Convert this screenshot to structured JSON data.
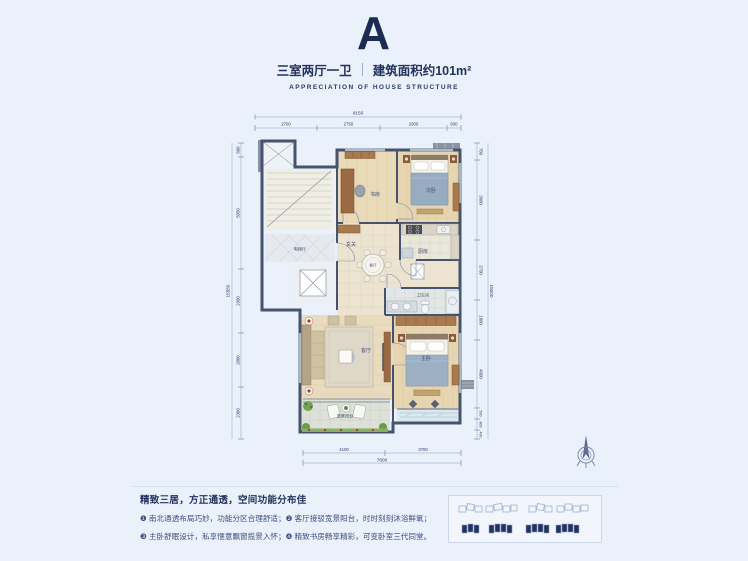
{
  "header": {
    "unit_letter": "A",
    "spec": "三室两厅一卫",
    "area": "建筑面积约101m²",
    "subtitle": "APPRECIATION OF HOUSE STRUCTURE"
  },
  "plan": {
    "rooms": {
      "elevator_hall": "电梯厅",
      "study": "书房",
      "bedroom2": "次卧",
      "foyer": "玄关",
      "dining": "餐厅",
      "kitchen": "厨房",
      "bathroom": "卫生间",
      "living": "客厅",
      "master": "主卧",
      "balcony": "宽景阳台"
    },
    "dims": {
      "top_total": "9150",
      "top": [
        "2700",
        "2750",
        "2900",
        "600"
      ],
      "bottom_total": "7800",
      "bottom": [
        "4100",
        "3700"
      ],
      "left_total": "15550",
      "left": [
        "600",
        "5050",
        "2900",
        "2000",
        "2300"
      ],
      "right_total": "15000",
      "right": [
        "780",
        "3600",
        "2700",
        "1800",
        "4000",
        "500",
        "800",
        "400"
      ]
    }
  },
  "footer": {
    "headline": "精致三居，方正通透，空间功能分布佳",
    "bullet_line1": "❶ 南北通透布局巧妙，功能分区合理舒适；❷ 客厅接驳宽景阳台，时时刻刻沐浴鲜氧；",
    "bullet_line2": "❸ 主卧舒眠设计，私享惬意飘窗揽景入怀；❹ 精致书房畅享精彩，可变卧室三代同堂。"
  },
  "colors": {
    "accent": "#1c2b52",
    "text": "#23335e",
    "wall": "#46536e",
    "wood": "#e8d9b6",
    "dim_text": "#2f3f6a"
  }
}
